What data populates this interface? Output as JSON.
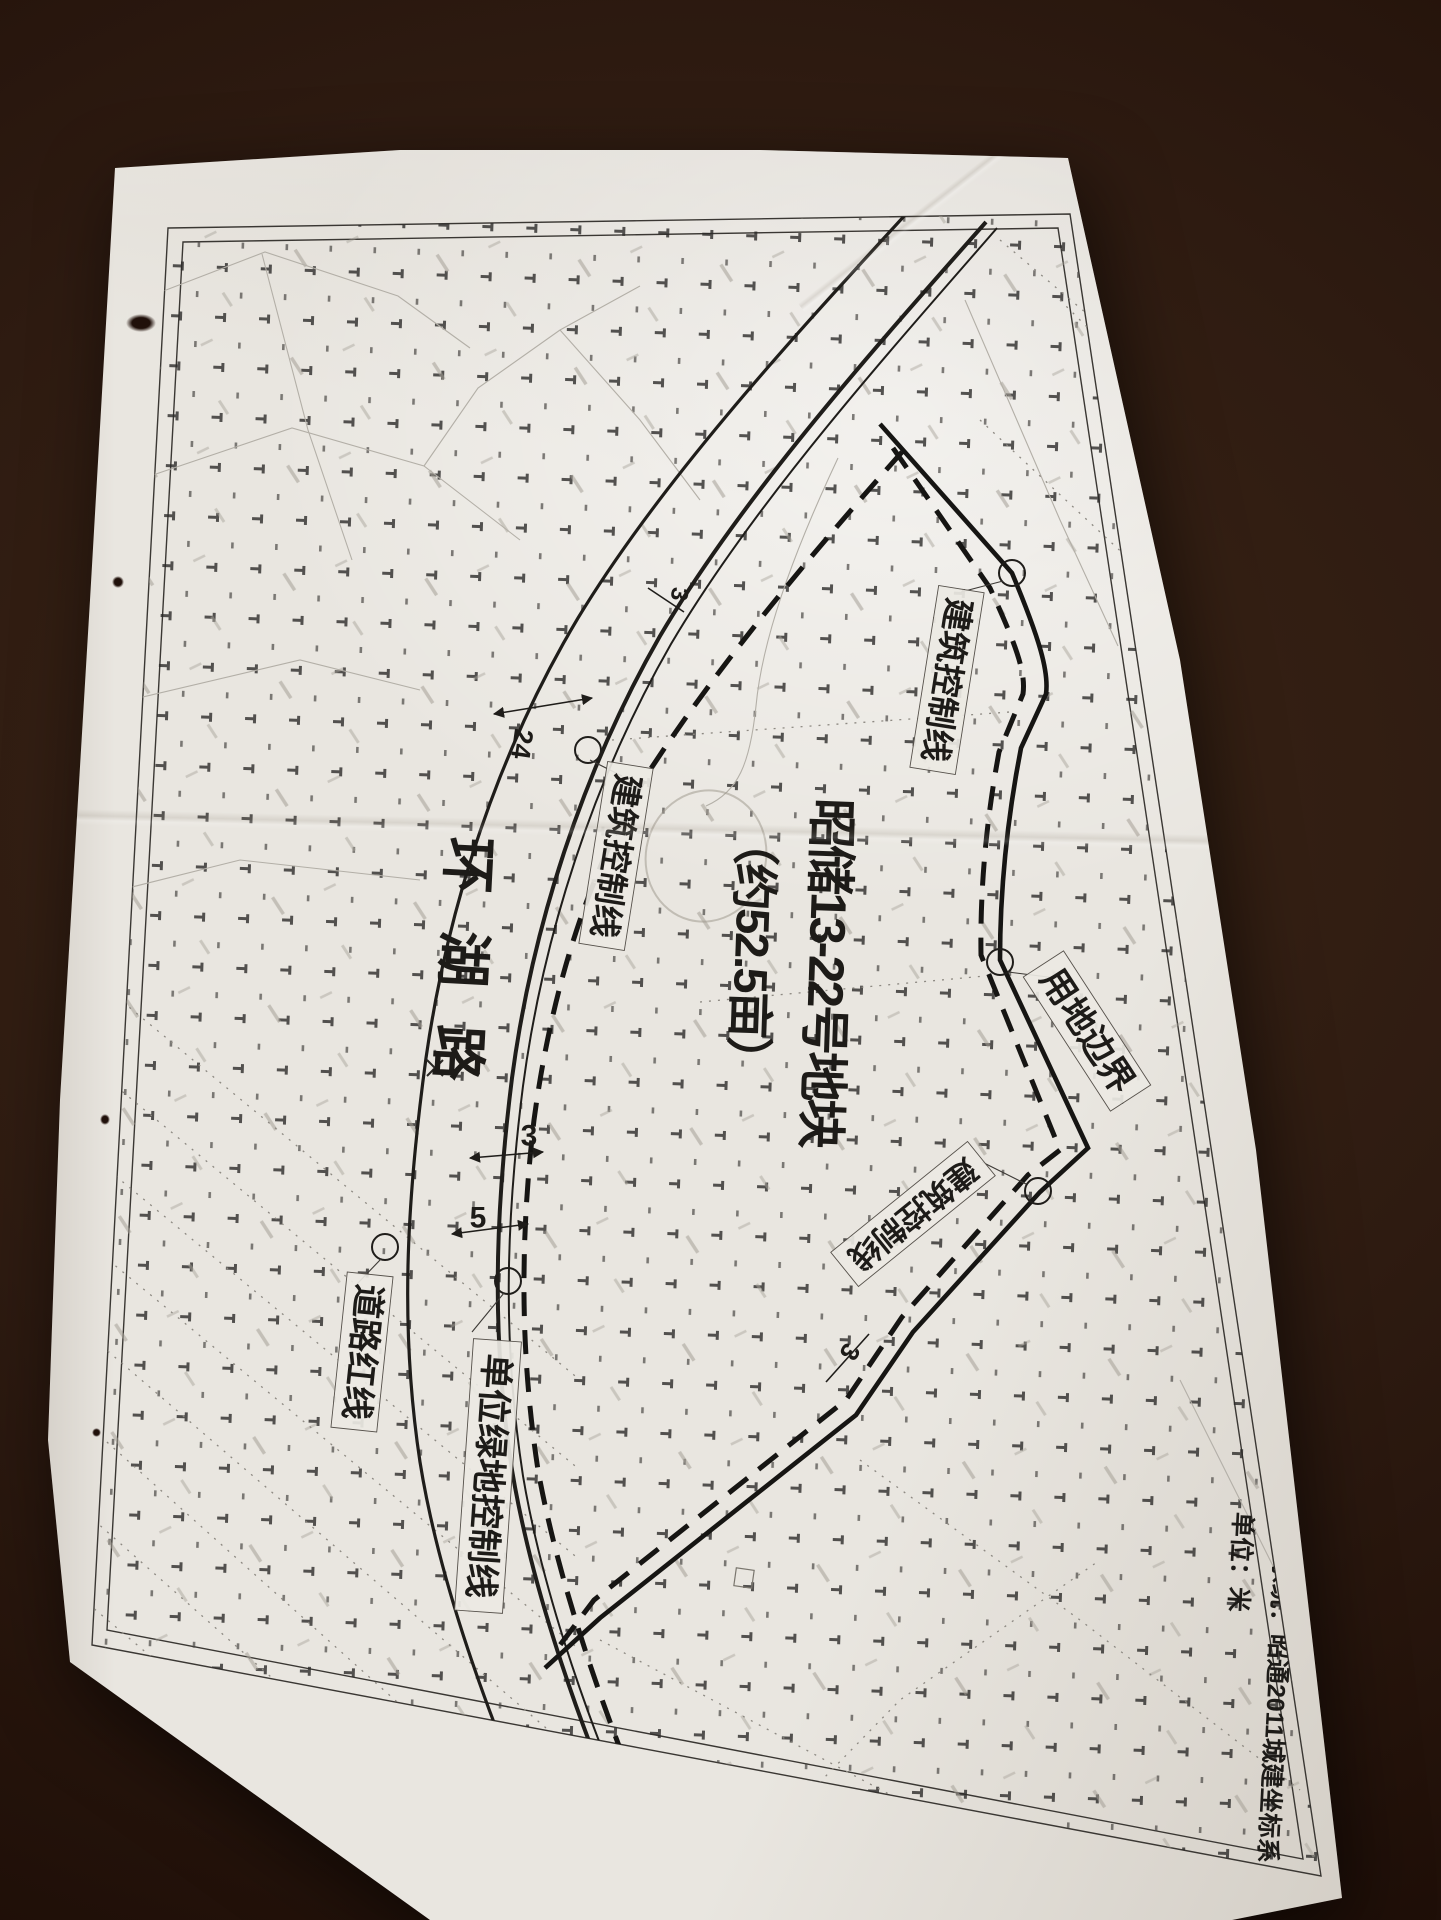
{
  "scene": {
    "background_color": "#2e1b11",
    "paper_color": "#e9e6e0",
    "ink_color": "#1f1d1a"
  },
  "title": {
    "line1": "昭储13-22号地块",
    "line2": "（约52.5亩）"
  },
  "road": {
    "name": "环湖路"
  },
  "labels": {
    "building_control_top": "建筑控制线",
    "building_control_west": "建筑控制线",
    "building_control_southeast": "建筑控制线",
    "land_use_boundary": "用地边界",
    "road_red_line": "道路红线",
    "unit_green_space_control": "单位绿地控制线"
  },
  "dimensions": {
    "green_belt": "24",
    "setback_top": "3",
    "setback_mid": "3",
    "setback_green": "5",
    "setback_southeast": "3"
  },
  "notes": {
    "coordinate_system": "坐标系统：昭通2011城建坐标系",
    "unit": "单位：米"
  }
}
